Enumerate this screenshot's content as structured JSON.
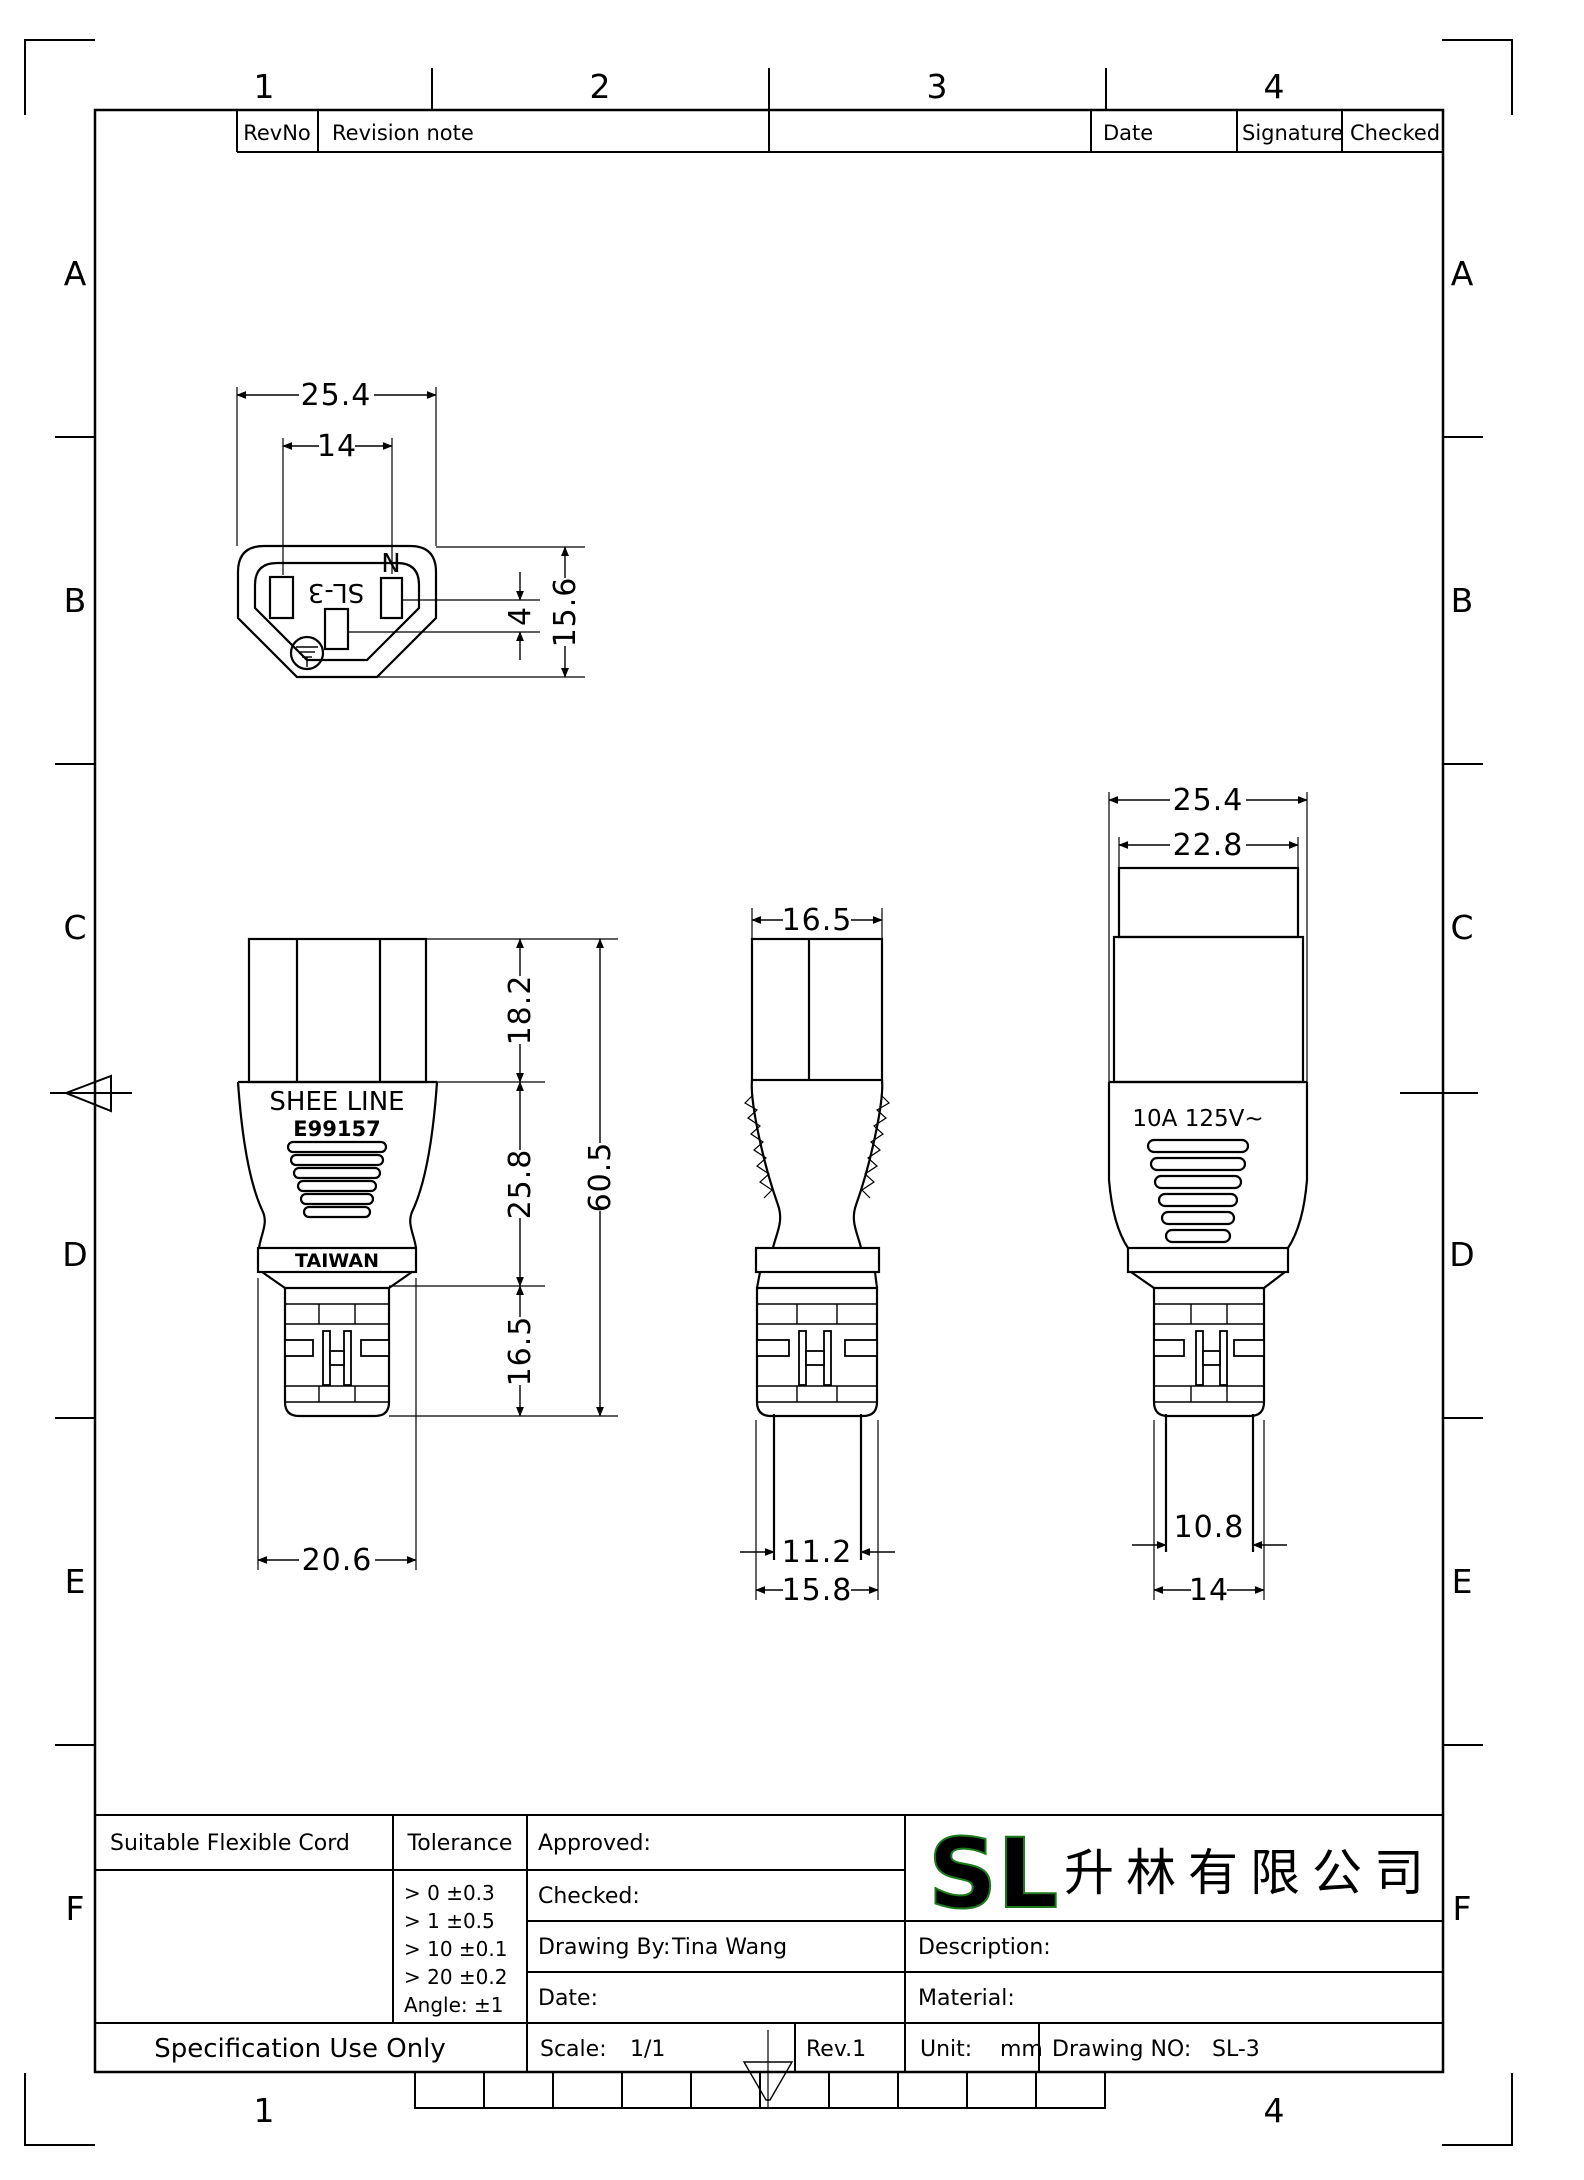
{
  "grid": {
    "cols": [
      "1",
      "2",
      "3",
      "4"
    ],
    "rows": [
      "A",
      "B",
      "C",
      "D",
      "E",
      "F"
    ]
  },
  "revision_table": {
    "rev_no": "RevNo",
    "revision_note": "Revision note",
    "date": "Date",
    "signature": "Signature",
    "checked": "Checked"
  },
  "views": {
    "face": {
      "model_marking": "SL-3",
      "neutral_marking": "N",
      "dim_overall_width": "25.4",
      "dim_pin_spacing": "14",
      "dim_pin_offset": "4",
      "dim_overall_height": "15.6"
    },
    "front": {
      "brand": "SHEE LINE",
      "ul_number": "E99157",
      "origin": "TAIWAN",
      "dim_top": "18.2",
      "dim_mid": "25.8",
      "dim_strain": "16.5",
      "dim_total": "60.5",
      "dim_bottom_width": "20.6"
    },
    "side": {
      "dim_width": "16.5",
      "dim_cable": "11.2",
      "dim_strain_width": "15.8"
    },
    "back": {
      "rating": "10A 125V~",
      "dim_overall_width": "25.4",
      "dim_neck_width": "22.8",
      "dim_cable": "10.8",
      "dim_strain_width": "14"
    }
  },
  "title_block": {
    "suitable_flexible_cord": "Suitable Flexible Cord",
    "tolerance_label": "Tolerance",
    "tolerances": [
      "> 0  ±0.3",
      "> 1  ±0.5",
      "> 10  ±0.1",
      "> 20  ±0.2",
      "Angle: ±1"
    ],
    "approved_label": "Approved:",
    "checked_label": "Checked:",
    "drawing_by_label": "Drawing By:",
    "drawing_by_value": "Tina Wang",
    "date_label": "Date:",
    "logo_text": "SL",
    "logo_color": "#3ed63e",
    "company_name": "升林有限公司",
    "description_label": "Description:",
    "material_label": "Material:",
    "spec_use_only": "Specification Use Only",
    "scale_label": "Scale:",
    "scale_value": "1/1",
    "rev": "Rev.1",
    "unit_label": "Unit:",
    "unit_value": "mm",
    "drawing_no_label": "Drawing NO:",
    "drawing_no_value": "SL-3"
  }
}
